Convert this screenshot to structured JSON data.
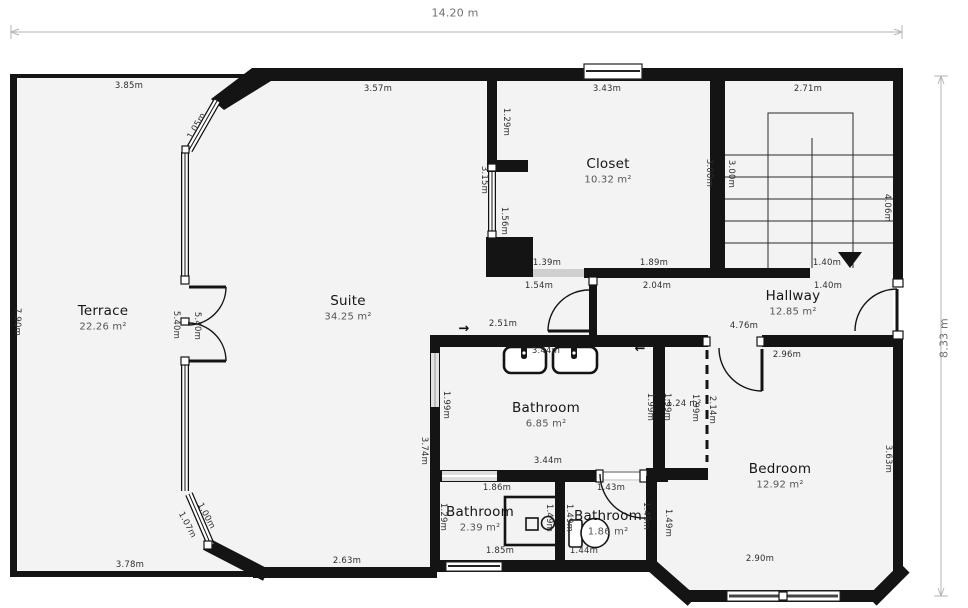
{
  "plan": {
    "width_label": "14.20 m",
    "height_label": "8.33 m"
  },
  "rooms": [
    {
      "name": "Terrace",
      "area": "22.26 m²",
      "x": 103,
      "y": 311
    },
    {
      "name": "Suite",
      "area": "34.25 m²",
      "x": 348,
      "y": 301
    },
    {
      "name": "Closet",
      "area": "10.32 m²",
      "x": 608,
      "y": 164
    },
    {
      "name": "Hallway",
      "area": "12.85 m²",
      "x": 793,
      "y": 296
    },
    {
      "name": "Bathroom",
      "area": "6.85 m²",
      "x": 546,
      "y": 408
    },
    {
      "name": "Bathroom",
      "area": "2.39 m²",
      "x": 480,
      "y": 512
    },
    {
      "name": "Bathroom",
      "area": "1.86 m²",
      "x": 608,
      "y": 516
    },
    {
      "name": "Bedroom",
      "area": "12.92 m²",
      "x": 780,
      "y": 469
    }
  ],
  "dimensions": [
    {
      "t": "3.85m",
      "x": 129,
      "y": 86
    },
    {
      "t": "3.57m",
      "x": 378,
      "y": 89
    },
    {
      "t": "3.43m",
      "x": 607,
      "y": 89
    },
    {
      "t": "2.71m",
      "x": 808,
      "y": 89
    },
    {
      "t": "1.05m",
      "x": 197,
      "y": 126,
      "r": -60
    },
    {
      "t": "1.29m",
      "x": 506,
      "y": 122,
      "r": 90
    },
    {
      "t": "3.15m",
      "x": 484,
      "y": 180,
      "r": 90
    },
    {
      "t": "1.56m",
      "x": 504,
      "y": 221,
      "r": 90
    },
    {
      "t": "3.00m",
      "x": 709,
      "y": 173,
      "r": 90
    },
    {
      "t": "3.00m",
      "x": 731,
      "y": 174,
      "r": 90
    },
    {
      "t": "4.06m",
      "x": 887,
      "y": 208,
      "r": 90
    },
    {
      "t": "1.39m",
      "x": 547,
      "y": 263
    },
    {
      "t": "1.89m",
      "x": 654,
      "y": 263
    },
    {
      "t": "1.40m",
      "x": 827,
      "y": 263
    },
    {
      "t": "1.54m",
      "x": 539,
      "y": 286
    },
    {
      "t": "2.04m",
      "x": 657,
      "y": 286
    },
    {
      "t": "1.40m",
      "x": 828,
      "y": 286
    },
    {
      "t": "7.90m",
      "x": 17,
      "y": 322,
      "r": 90
    },
    {
      "t": "5.40m",
      "x": 176,
      "y": 325,
      "r": 90
    },
    {
      "t": "5.40m",
      "x": 197,
      "y": 326,
      "r": 90
    },
    {
      "t": "2.51m",
      "x": 503,
      "y": 324
    },
    {
      "t": "4.76m",
      "x": 744,
      "y": 326
    },
    {
      "t": "2.96m",
      "x": 787,
      "y": 355
    },
    {
      "t": "3.44m",
      "x": 546,
      "y": 351
    },
    {
      "t": "1.99m",
      "x": 446,
      "y": 405,
      "r": 90
    },
    {
      "t": "3.74m",
      "x": 424,
      "y": 451,
      "r": 90
    },
    {
      "t": "1.99m",
      "x": 650,
      "y": 407,
      "r": 90
    },
    {
      "t": "1.99m",
      "x": 667,
      "y": 407,
      "r": 90
    },
    {
      "t": "1.24 m²",
      "x": 684,
      "y": 404
    },
    {
      "t": "1.99m",
      "x": 695,
      "y": 408,
      "r": 90
    },
    {
      "t": "2.14m",
      "x": 712,
      "y": 410,
      "r": 90
    },
    {
      "t": "3.44m",
      "x": 548,
      "y": 461
    },
    {
      "t": "3.63m",
      "x": 888,
      "y": 459,
      "r": 90
    },
    {
      "t": "1.86m",
      "x": 497,
      "y": 488
    },
    {
      "t": "1.43m",
      "x": 611,
      "y": 488
    },
    {
      "t": "1.29m",
      "x": 443,
      "y": 517,
      "r": 90
    },
    {
      "t": "1.49m",
      "x": 549,
      "y": 518,
      "r": 90
    },
    {
      "t": "1.49m",
      "x": 569,
      "y": 518,
      "r": 90
    },
    {
      "t": "1.49m",
      "x": 646,
      "y": 516,
      "r": 90
    },
    {
      "t": "1.49m",
      "x": 668,
      "y": 523,
      "r": 90
    },
    {
      "t": "1.00m",
      "x": 206,
      "y": 516,
      "r": 62
    },
    {
      "t": "1.07m",
      "x": 187,
      "y": 525,
      "r": 62
    },
    {
      "t": "1.85m",
      "x": 500,
      "y": 551
    },
    {
      "t": "1.44m",
      "x": 584,
      "y": 551
    },
    {
      "t": "2.63m",
      "x": 347,
      "y": 561
    },
    {
      "t": "3.78m",
      "x": 130,
      "y": 565
    },
    {
      "t": "2.90m",
      "x": 760,
      "y": 559
    }
  ],
  "arrows": [
    {
      "t": "→",
      "x": 464,
      "y": 329
    },
    {
      "t": "←",
      "x": 640,
      "y": 349
    }
  ],
  "colors": {
    "wall": "#141414",
    "floor": "#f3f3f3",
    "dimension_line": "#b5b5b5",
    "opening": "#cfcfcf"
  }
}
